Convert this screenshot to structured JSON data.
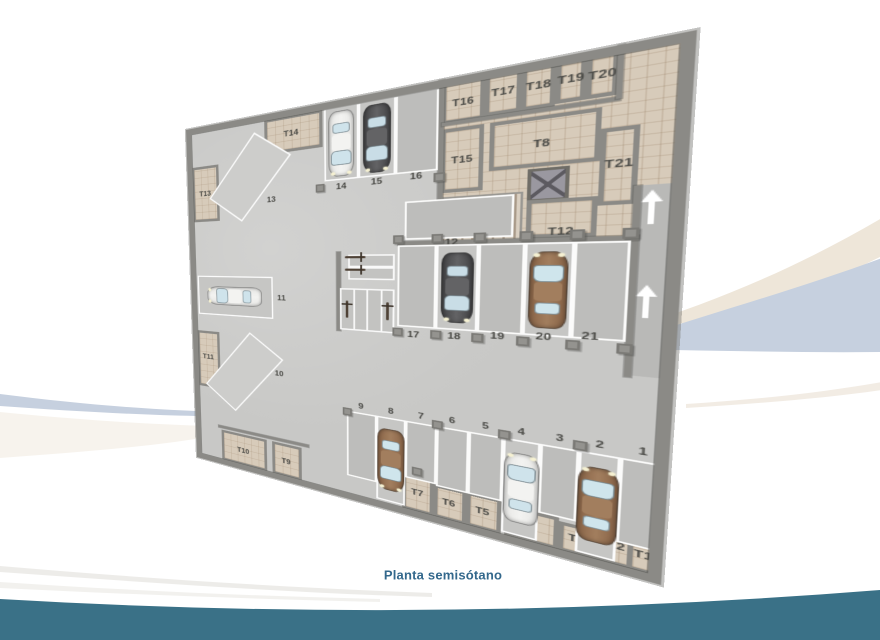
{
  "caption": {
    "text": "Planta semisótano"
  },
  "theme": {
    "page_bg": "#ffffff",
    "footer_teal": "#3a7187",
    "caption_color": "#33688c",
    "swoosh_beige": "#eee6d9",
    "swoosh_blue": "#c6d0df",
    "swoosh_beige_faint": "#f0e9df",
    "swoosh_gray_faint": "#e9e7e3",
    "wall": "#8b8a86",
    "floor": "#c8c8c6",
    "spot_empty": "#bdbdbb",
    "beige": "#d7cbba",
    "beige_line": "rgba(150,125,98,0.25)",
    "ramp": "#b9b9b7",
    "pillar": "#94938f",
    "label": "#4a4a46"
  },
  "plan": {
    "parking_spots": [
      {
        "id": "14",
        "rect": [
          200,
          8,
          40,
          97
        ],
        "label_xy": [
          220,
          114
        ],
        "car": "white",
        "front": "down"
      },
      {
        "id": "15",
        "rect": [
          240,
          8,
          40,
          97
        ],
        "label_xy": [
          260,
          112
        ],
        "car": "dark",
        "front": "down"
      },
      {
        "id": "16",
        "rect": [
          280,
          8,
          42,
          97
        ],
        "label_xy": [
          301,
          110
        ]
      },
      {
        "id": "12",
        "rect": [
          290,
          140,
          100,
          48
        ],
        "label_xy": [
          336,
          193
        ]
      },
      {
        "id": "17",
        "rect": [
          283,
          195,
          39,
          105
        ],
        "label_xy": [
          300,
          310
        ]
      },
      {
        "id": "18",
        "rect": [
          322,
          195,
          39,
          105
        ],
        "label_xy": [
          340,
          308
        ],
        "car": "dark",
        "front": "down"
      },
      {
        "id": "19",
        "rect": [
          361,
          195,
          39,
          105
        ],
        "label_xy": [
          379,
          304
        ]
      },
      {
        "id": "20",
        "rect": [
          400,
          195,
          38,
          105
        ],
        "label_xy": [
          417,
          301
        ],
        "car": "brown",
        "front": "up"
      },
      {
        "id": "21",
        "rect": [
          438,
          195,
          39,
          105
        ],
        "label_xy": [
          452,
          297
        ]
      },
      {
        "id": "11",
        "rect": [
          12,
          238,
          118,
          64
        ],
        "label_xy": [
          142,
          270
        ],
        "car": "white",
        "front": "left"
      },
      {
        "id": "9",
        "rect": [
          226,
          425,
          35,
          95
        ],
        "label_xy": [
          243,
          416
        ]
      },
      {
        "id": "8",
        "rect": [
          261,
          425,
          32,
          118
        ],
        "label_xy": [
          277,
          416
        ],
        "car": "brown",
        "front": "down"
      },
      {
        "id": "7",
        "rect": [
          293,
          425,
          32,
          78
        ],
        "label_xy": [
          309,
          416
        ]
      },
      {
        "id": "6",
        "rect": [
          325,
          425,
          31,
          80
        ],
        "label_xy": [
          340,
          415
        ]
      },
      {
        "id": "5",
        "rect": [
          356,
          425,
          31,
          80
        ],
        "label_xy": [
          371,
          415
        ]
      },
      {
        "id": "4",
        "rect": [
          387,
          425,
          31,
          118
        ],
        "label_xy": [
          402,
          415
        ],
        "car": "white",
        "front": "up"
      },
      {
        "id": "3",
        "rect": [
          418,
          425,
          30,
          83
        ],
        "label_xy": [
          433,
          415
        ]
      },
      {
        "id": "2",
        "rect": [
          448,
          425,
          30,
          118
        ],
        "label_xy": [
          463,
          415
        ],
        "car": "brown",
        "front": "up"
      },
      {
        "id": "1",
        "rect": [
          478,
          425,
          30,
          95
        ],
        "label_xy": [
          493,
          415
        ]
      }
    ],
    "diagonal_spots": [
      {
        "id": "13",
        "cx": 95,
        "cy": 86,
        "w": 60,
        "h": 112,
        "rot": 38,
        "label_xy": [
          130,
          124
        ]
      },
      {
        "id": "10",
        "cx": 80,
        "cy": 390,
        "w": 58,
        "h": 116,
        "rot": 38,
        "label_xy": [
          137,
          386
        ]
      }
    ],
    "storage_rooms": [
      {
        "id": "T14",
        "rect": [
          122,
          8,
          76,
          50
        ],
        "label_xy": [
          158,
          33
        ]
      },
      {
        "id": "T13",
        "rect": [
          8,
          62,
          44,
          88
        ],
        "label_xy": [
          29,
          106
        ]
      },
      {
        "id": "T11",
        "rect": [
          8,
          330,
          38,
          95
        ],
        "label_xy": [
          26,
          374
        ]
      },
      {
        "id": "T10",
        "rect": [
          45,
          495,
          72,
          52
        ],
        "label_xy": [
          80,
          523
        ]
      },
      {
        "id": "T9",
        "rect": [
          125,
          495,
          42,
          52
        ],
        "label_xy": [
          145,
          523
        ]
      },
      {
        "id": "T7",
        "rect": [
          290,
          498,
          33,
          49
        ],
        "label_xy": [
          306,
          521
        ]
      },
      {
        "id": "T6",
        "rect": [
          323,
          503,
          32,
          44
        ],
        "label_xy": [
          338,
          524
        ]
      },
      {
        "id": "T5",
        "rect": [
          355,
          503,
          32,
          44
        ],
        "label_xy": [
          370,
          524
        ]
      },
      {
        "id": "T4",
        "rect": [
          390,
          508,
          45,
          39
        ],
        "label_xy": [
          411,
          527
        ]
      },
      {
        "id": "T3",
        "rect": [
          435,
          512,
          30,
          35
        ],
        "label_xy": [
          449,
          529
        ]
      },
      {
        "id": "T2",
        "rect": [
          465,
          505,
          28,
          42
        ],
        "label_xy": [
          478,
          525
        ]
      },
      {
        "id": "T1",
        "rect": [
          486,
          510,
          24,
          37
        ],
        "label_xy": [
          497,
          528
        ]
      }
    ],
    "core_block": [
      322,
      0,
      188,
      195
    ],
    "core_rooms": [
      {
        "id": "T16",
        "rect": [
          325,
          0,
          38,
          52
        ],
        "label_xy": [
          344,
          30
        ]
      },
      {
        "id": "T17",
        "rect": [
          363,
          0,
          30,
          50
        ],
        "label_xy": [
          378,
          26
        ]
      },
      {
        "id": "T18",
        "rect": [
          393,
          0,
          26,
          50
        ],
        "label_xy": [
          406,
          26
        ]
      },
      {
        "id": "T19",
        "rect": [
          419,
          0,
          22,
          48
        ],
        "label_xy": [
          430,
          25
        ]
      },
      {
        "id": "T20",
        "rect": [
          441,
          0,
          22,
          48
        ],
        "label_xy": [
          452,
          26
        ]
      },
      {
        "id": "T15",
        "rect": [
          325,
          58,
          38,
          75
        ],
        "label_xy": [
          344,
          96
        ]
      },
      {
        "id": "T8",
        "rect": [
          368,
          58,
          85,
          54
        ],
        "label_xy": [
          410,
          88
        ]
      },
      {
        "id": "T21",
        "rect": [
          453,
          80,
          26,
          78
        ],
        "label_xy": [
          466,
          117
        ]
      },
      {
        "id": "T12",
        "rect": [
          400,
          148,
          53,
          42
        ],
        "label_xy": [
          427,
          184
        ]
      }
    ],
    "stairs": [
      325,
      138,
      72,
      55
    ],
    "elevator": [
      400,
      114,
      32,
      36
    ],
    "ramp": [
      480,
      140,
      30,
      195
    ],
    "ramp_arrows": [
      [
        489,
        162
      ],
      [
        489,
        257
      ]
    ],
    "walls": [
      [
        322,
        0,
        5,
        195
      ],
      [
        477,
        140,
        5,
        197
      ],
      [
        325,
        50,
        140,
        4
      ],
      [
        462,
        0,
        4,
        52
      ],
      [
        283,
        190,
        199,
        5
      ],
      [
        214,
        202,
        5,
        110
      ],
      [
        40,
        488,
        137,
        4
      ]
    ],
    "moto_strips": [
      [
        228,
        206,
        52,
        17
      ],
      [
        228,
        223,
        52,
        17
      ]
    ],
    "moto_stalls": {
      "rect": [
        218,
        252,
        62,
        58
      ],
      "count": 4,
      "occupied": [
        0,
        3
      ]
    },
    "pillars": [
      [
        189,
        108
      ],
      [
        318,
        108
      ],
      [
        278,
        182
      ],
      [
        317,
        182
      ],
      [
        356,
        182
      ],
      [
        395,
        182
      ],
      [
        434,
        182
      ],
      [
        471,
        182
      ],
      [
        278,
        302
      ],
      [
        317,
        302
      ],
      [
        356,
        302
      ],
      [
        395,
        302
      ],
      [
        434,
        302
      ],
      [
        471,
        302
      ],
      [
        221,
        421
      ],
      [
        320,
        418
      ],
      [
        382,
        416
      ],
      [
        443,
        414
      ],
      [
        300,
        486
      ]
    ],
    "car_colors": {
      "white": {
        "body": "#e7e7e5",
        "roof": "#f3f3f1",
        "glass": "#cfe3eb"
      },
      "dark": {
        "body": "#454547",
        "roof": "#636365",
        "glass": "#c9dde6"
      },
      "brown": {
        "body": "#8a6548",
        "roof": "#a27e5e",
        "glass": "#cfe5ec"
      }
    }
  }
}
